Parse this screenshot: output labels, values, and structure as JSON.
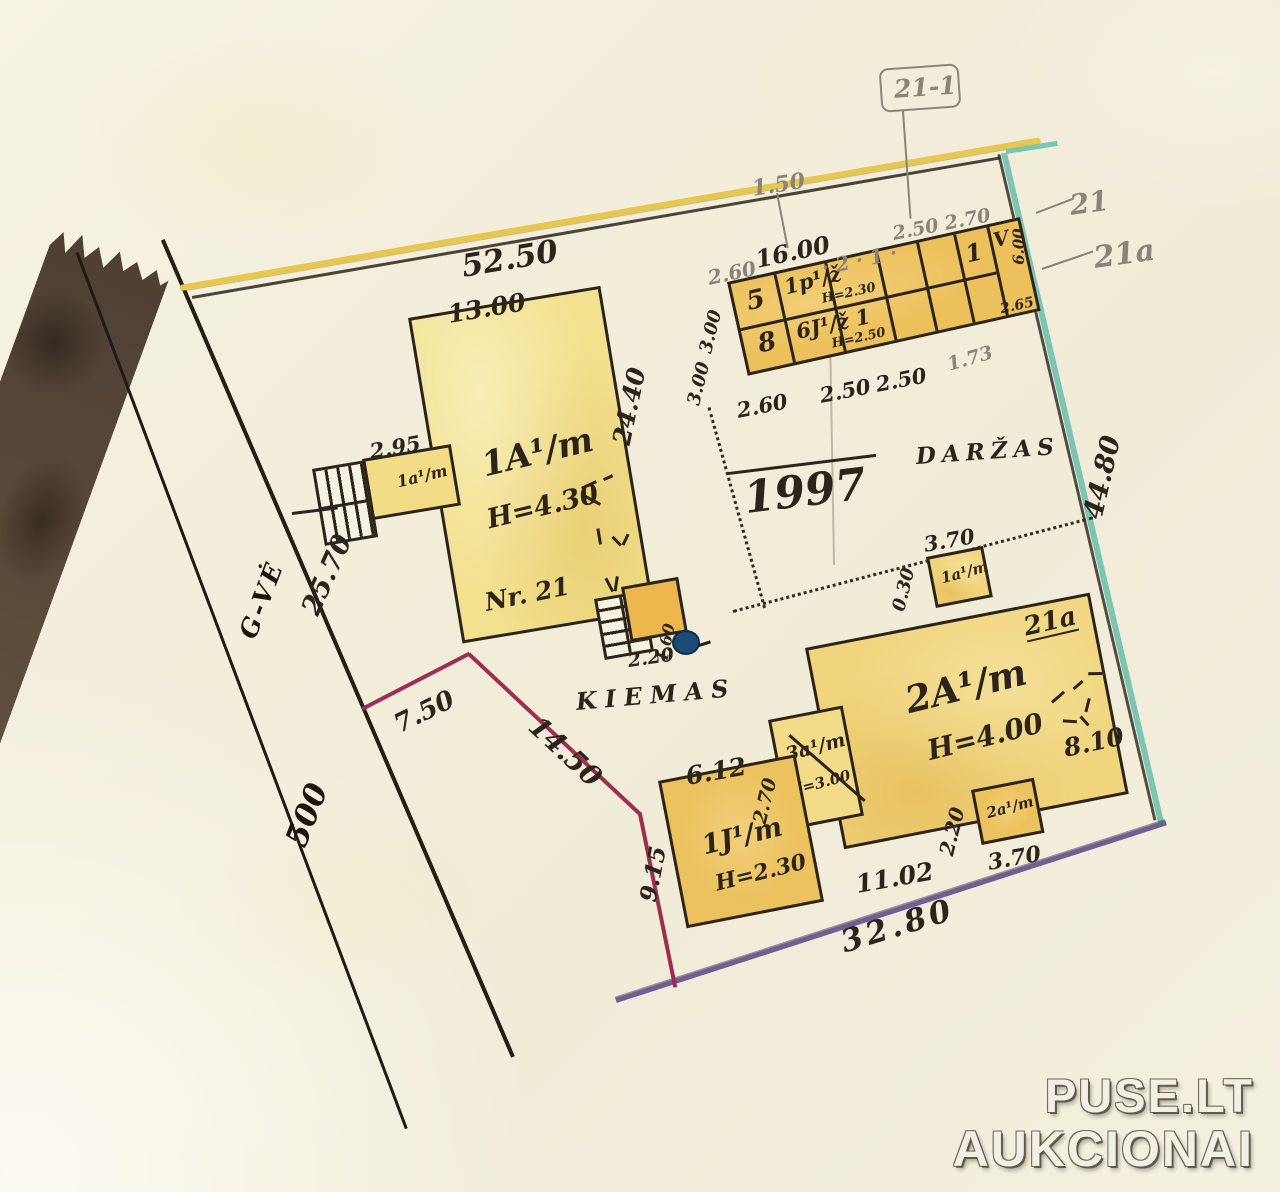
{
  "watermark": {
    "line1": "PUSE.LT",
    "line2": "AUKCIONAI"
  },
  "areas": {
    "yard": "KIEMAS",
    "garden": "DARŽAS",
    "year": "1997",
    "street_name": "G-VĖ",
    "street_number": "500"
  },
  "refs": {
    "flag": "21-1",
    "house21": "21",
    "house21a": "21a"
  },
  "boundary": {
    "north": "52.50",
    "north_gap": "1.50",
    "east": "44.80",
    "south": "32.80",
    "west": "25.70",
    "red_a": "7.50",
    "red_b": "14.50",
    "red_c": "9.15"
  },
  "b1": {
    "code": "1A¹/m",
    "height": "H=4.30",
    "number": "Nr. 21",
    "width": "13.00",
    "length": "24.40",
    "annex_code": "1a¹/m",
    "annex_width": "2.95",
    "porch_depth": "2.20",
    "porch_side": "1.60"
  },
  "b2": {
    "code": "2A¹/m",
    "height": "H=4.00",
    "id": "21a",
    "bottom": "11.02",
    "right": "8.10",
    "annex_top_code": "1a¹/m",
    "annex_top_width": "3.70",
    "annex_top_depth": "0.30",
    "annex_left_code": "3a¹/m",
    "annex_left_height": "H=3.00",
    "annex_left_width": "2.70",
    "annex_bottom_code": "2a¹/m",
    "annex_bottom_depth": "2.20",
    "annex_bottom_width": "3.70"
  },
  "b3": {
    "code": "1J¹/m",
    "height": "H=2.30",
    "width": "6.12"
  },
  "sheds": {
    "cell5": "5",
    "cell8": "8",
    "row_top_code": "1p¹/ž",
    "row_top_h": "H=2.30",
    "row_bottom_code": "6J¹/ž 1",
    "row_bottom_h": "H=2.50",
    "cell1": "1",
    "vmark": "V",
    "depth": "6.00",
    "end_width": "2.65",
    "pencil_top": "2.50 2.70",
    "pencil_row": "· 2 · 1 ·",
    "total_width": "16.00",
    "lead_width": "2.60",
    "left_a": "3.00",
    "left_b": "3.00",
    "below_a": "2.60",
    "below_b": "2.50",
    "below_c": "2.50",
    "right_gap": "1.73"
  }
}
